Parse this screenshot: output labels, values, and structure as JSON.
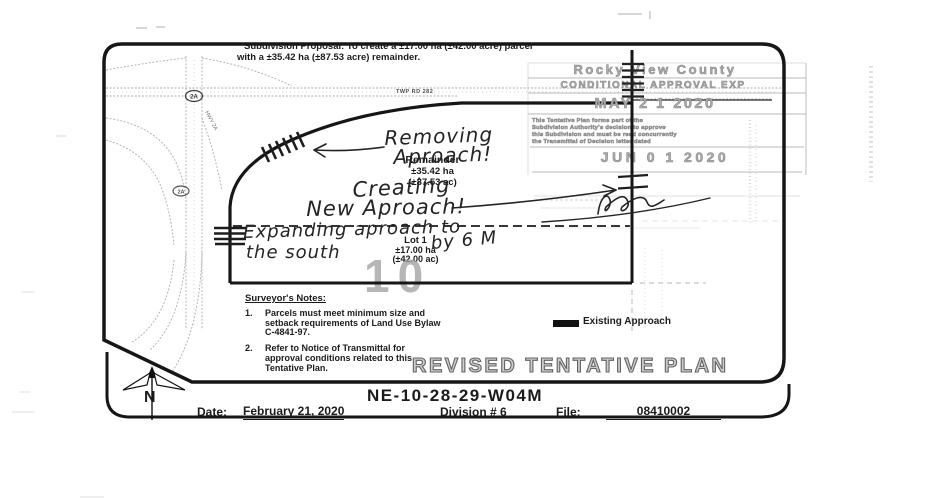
{
  "colors": {
    "ink": "#1b1b1b",
    "stamp_gray": "#a9a9a9",
    "outline_gray": "#cdcdcd"
  },
  "header": {
    "proposal_line1": "Subdivision Proposal: To create a ±17.00 ha (±42.00 acre) parcel",
    "proposal_line2": "with a ±35.42 ha (±87.53 acre) remainder."
  },
  "plan": {
    "roads": {
      "twp_rd": "TWP RD 282",
      "hwy_shield_1": "2A",
      "hwy_shield_2": "2A",
      "hwy_label": "HWY 2A"
    },
    "parcels": {
      "remainder": {
        "label": "Remainder",
        "area_ha": "±35.42 ha",
        "area_ac": "(±87.53 ac)"
      },
      "lot1": {
        "label": "Lot 1",
        "area_ha": "±17.00 ha",
        "area_ac": "(±42.00 ac)"
      },
      "section": "10"
    },
    "annotations": {
      "removing_line1": "Removing",
      "removing_line2": "Aproach!",
      "creating_line1": "Creating",
      "creating_line2": "New Aproach!",
      "expanding_line1": "Expanding aproach to",
      "expanding_line2": "the south",
      "expanding_line3": "by 6 M"
    },
    "legend": {
      "existing_approach": "Existing Approach"
    },
    "notes": {
      "heading": "Surveyor's Notes:",
      "items": [
        {
          "num": "1.",
          "text": "Parcels must meet minimum size and setback requirements of Land Use Bylaw C-4841-97."
        },
        {
          "num": "2.",
          "text": "Refer to Notice of Transmittal for approval conditions related to this Tentative Plan."
        }
      ]
    }
  },
  "stamps": {
    "county": "Rocky View County",
    "approval": "CONDITIONAL APPROVAL EXP",
    "date1": "MAY 2 1 2020",
    "fine_print": [
      "This Tentative Plan forms part of the",
      "Subdivision Authority's decision to approve",
      "this Subdivision and must be read concurrently",
      "the Transmittal of Decision letter dated"
    ],
    "date2": "JUN 0 1 2020"
  },
  "title_block": {
    "plan_type": "REVISED TENTATIVE PLAN",
    "legal": "NE-10-28-29-W04M",
    "date_label": "Date:",
    "date_value": "February 21, 2020",
    "division": "Division # 6",
    "file_label": "File:",
    "file_value": "08410002",
    "north": "N"
  }
}
